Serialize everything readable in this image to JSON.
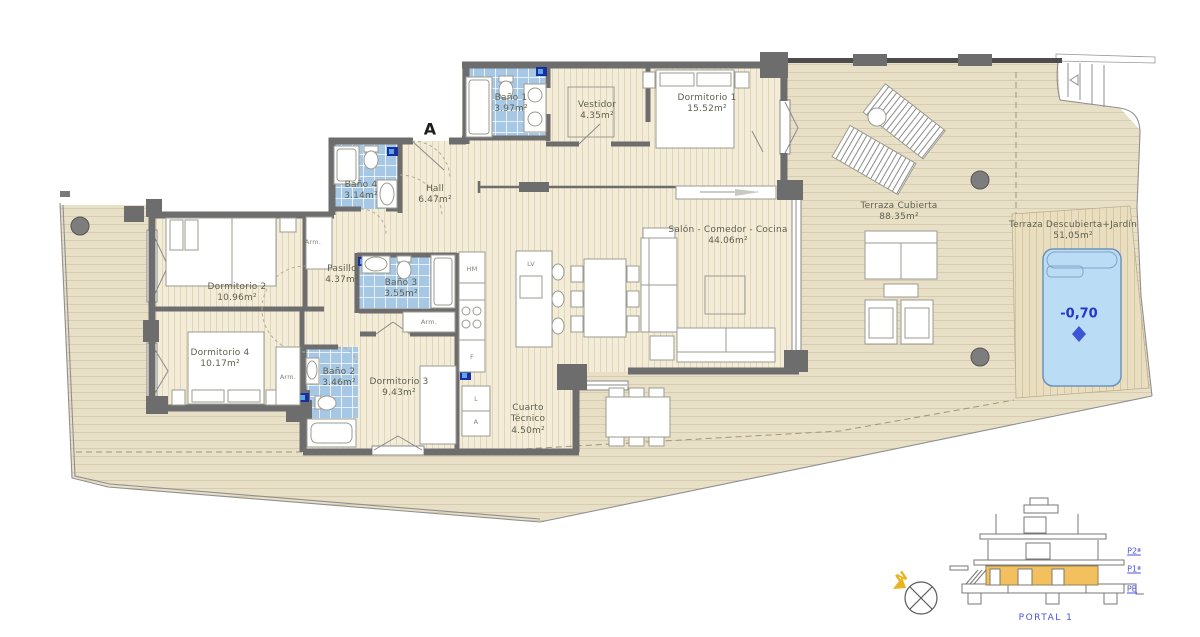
{
  "rooms": [
    {
      "name": "Baño 1",
      "area": "3.97m²"
    },
    {
      "name": "Vestidor",
      "area": "4.35m²"
    },
    {
      "name": "Dormitorio 1",
      "area": "15.52m²"
    },
    {
      "name": "Baño 4",
      "area": "3.14m²"
    },
    {
      "name": "Hall",
      "area": "6.47m²"
    },
    {
      "name": "Dormitorio 2",
      "area": "10.96m²"
    },
    {
      "name": "Pasillo",
      "area": "4.37m²"
    },
    {
      "name": "Baño 3",
      "area": "3.55m²"
    },
    {
      "name": "Salón - Comedor - Cocina",
      "area": "44.06m²"
    },
    {
      "name": "Dormitorio 4",
      "area": "10.17m²"
    },
    {
      "name": "Baño 2",
      "area": "3.46m²"
    },
    {
      "name": "Dormitorio 3",
      "area": "9.43m²"
    },
    {
      "name": "Cuarto Técnico",
      "area": "4.50m²"
    },
    {
      "name": "Terraza Cubierta",
      "area": "88.35m²"
    },
    {
      "name": "Terraza Descubierta+Jardín",
      "area": "51,05m²"
    }
  ],
  "labels": {
    "armario": "Arm.",
    "oven": "HM",
    "dishwasher": "LV",
    "fridge": "F",
    "washer": "L",
    "boiler": "A",
    "entrance": "A"
  },
  "pool": {
    "depth": "-0,70"
  },
  "section": {
    "floors": [
      {
        "label": "P2ª"
      },
      {
        "label": "P1ª"
      },
      {
        "label": "PB"
      }
    ],
    "portal": "PORTAL 1"
  },
  "compass": {
    "north": "N"
  },
  "colors": {
    "wall": "#6d6d6d",
    "interior_floor": "#f3ecd9",
    "terrace": "#e8dfc7",
    "garden": "#e9dec0",
    "bath_tile": "#a7c8e4",
    "pool_water": "#badcf4",
    "plan_blue": "#4a52d8",
    "section_highlight": "#f3c05e",
    "north_yellow": "#eab421"
  }
}
